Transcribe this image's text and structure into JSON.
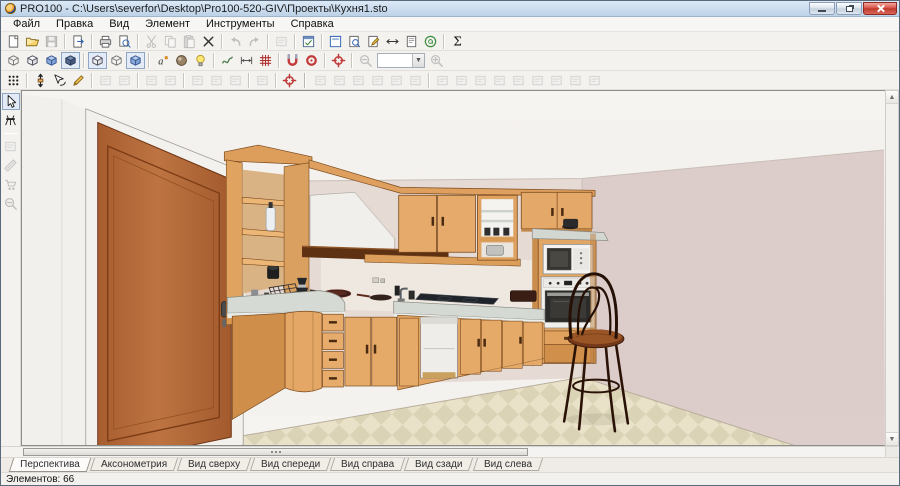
{
  "window": {
    "title": "PRO100 - C:\\Users\\severfor\\Desktop\\Pro100-520-GIV\\Проекты\\Кухня1.sto",
    "controls": [
      {
        "name": "minimize-button"
      },
      {
        "name": "restore-button"
      },
      {
        "name": "close-button"
      }
    ]
  },
  "menu": {
    "items": [
      "Файл",
      "Правка",
      "Вид",
      "Элемент",
      "Инструменты",
      "Справка"
    ]
  },
  "toolbars": {
    "row1": [
      {
        "name": "new-file",
        "i": "doc"
      },
      {
        "name": "open-file",
        "i": "folder"
      },
      {
        "name": "save-file",
        "i": "save",
        "disabled": true
      },
      {
        "sep": true
      },
      {
        "name": "report",
        "i": "docarrow"
      },
      {
        "sep": true
      },
      {
        "name": "print",
        "i": "printer"
      },
      {
        "name": "print-preview",
        "i": "preview"
      },
      {
        "sep": true
      },
      {
        "name": "cut",
        "i": "cut",
        "disabled": true
      },
      {
        "name": "copy",
        "i": "copy",
        "disabled": true
      },
      {
        "name": "paste",
        "i": "paste",
        "disabled": true
      },
      {
        "name": "delete",
        "i": "cross"
      },
      {
        "sep": true
      },
      {
        "name": "undo",
        "i": "undo",
        "disabled": true
      },
      {
        "name": "redo",
        "i": "redo",
        "disabled": true
      },
      {
        "sep": true
      },
      {
        "name": "insert-element",
        "i": "generic",
        "disabled": true
      },
      {
        "sep": true
      },
      {
        "name": "properties-dialog",
        "i": "dialog"
      },
      {
        "sep": true
      },
      {
        "name": "panel-library",
        "i": "pageblue"
      },
      {
        "name": "panel-preview",
        "i": "pagemag"
      },
      {
        "name": "panel-properties",
        "i": "pageedit"
      },
      {
        "name": "panel-dimensions",
        "i": "arrlr"
      },
      {
        "name": "panel-report",
        "i": "pageplain"
      },
      {
        "name": "panel-info",
        "i": "atgreen"
      },
      {
        "sep": true
      },
      {
        "name": "price-list",
        "i": "sigma"
      }
    ],
    "row2": [
      {
        "name": "view-wireframe",
        "i": "boxwire"
      },
      {
        "name": "view-sketch",
        "i": "boxwhite"
      },
      {
        "name": "view-colored",
        "i": "boxblue"
      },
      {
        "name": "view-textured",
        "i": "boxdark",
        "pressed": true
      },
      {
        "sep": true
      },
      {
        "name": "show-contours",
        "i": "boxwhite",
        "pressed": true
      },
      {
        "name": "show-edges",
        "i": "boxwire"
      },
      {
        "name": "show-outline",
        "i": "boxblue",
        "pressed": true
      },
      {
        "sep": true
      },
      {
        "name": "auto-label",
        "i": "alabel"
      },
      {
        "name": "render-quality",
        "i": "sphere"
      },
      {
        "name": "lighting",
        "i": "bulb"
      },
      {
        "sep": true
      },
      {
        "name": "shadows",
        "i": "waves"
      },
      {
        "name": "dimensions-overlay",
        "i": "dimline"
      },
      {
        "name": "grid-overlay",
        "i": "gridred"
      },
      {
        "sep": true
      },
      {
        "name": "snap-to-objects",
        "i": "magnet"
      },
      {
        "name": "snap-to-grid",
        "i": "magnet2"
      },
      {
        "sep": true
      },
      {
        "name": "center-selection",
        "i": "target"
      },
      {
        "sep": true
      },
      {
        "name": "zoom-out",
        "i": "zoomout",
        "disabled": true
      },
      {
        "name": "zoom-level",
        "combo": true,
        "value": ""
      },
      {
        "name": "zoom-in",
        "i": "zoomin",
        "disabled": true
      }
    ],
    "row3": [
      {
        "name": "selection-filter",
        "i": "dotsgrid"
      },
      {
        "sep": true
      },
      {
        "name": "move-element",
        "i": "movearrows"
      },
      {
        "name": "rotate-element",
        "i": "rotatecursor"
      },
      {
        "name": "edit-shape",
        "i": "pencil"
      },
      {
        "sep": true
      },
      {
        "name": "group",
        "i": "generic",
        "disabled": true
      },
      {
        "name": "ungroup",
        "i": "generic",
        "disabled": true
      },
      {
        "sep": true
      },
      {
        "name": "move-up-level",
        "i": "generic",
        "disabled": true
      },
      {
        "name": "move-down-level",
        "i": "generic",
        "disabled": true
      },
      {
        "sep": true
      },
      {
        "name": "rotate-step",
        "i": "generic",
        "disabled": true
      },
      {
        "name": "move-step",
        "i": "generic",
        "disabled": true
      },
      {
        "name": "raise-step",
        "i": "generic",
        "disabled": true
      },
      {
        "sep": true
      },
      {
        "name": "corner-join",
        "i": "generic",
        "disabled": true
      },
      {
        "sep": true
      },
      {
        "name": "center-view",
        "i": "target"
      },
      {
        "sep": "thick"
      },
      {
        "name": "align-tool-1",
        "i": "generic",
        "disabled": true
      },
      {
        "name": "align-tool-2",
        "i": "generic",
        "disabled": true
      },
      {
        "name": "align-tool-3",
        "i": "generic",
        "disabled": true
      },
      {
        "name": "align-tool-4",
        "i": "generic",
        "disabled": true
      },
      {
        "name": "align-tool-5",
        "i": "generic",
        "disabled": true
      },
      {
        "name": "align-tool-6",
        "i": "generic",
        "disabled": true
      },
      {
        "sep": true
      },
      {
        "name": "arrange-tool-1",
        "i": "generic",
        "disabled": true
      },
      {
        "name": "arrange-tool-2",
        "i": "generic",
        "disabled": true
      },
      {
        "name": "arrange-tool-3",
        "i": "generic",
        "disabled": true
      },
      {
        "name": "arrange-tool-4",
        "i": "generic",
        "disabled": true
      },
      {
        "name": "arrange-tool-5",
        "i": "generic",
        "disabled": true
      },
      {
        "name": "arrange-tool-6",
        "i": "generic",
        "disabled": true
      },
      {
        "name": "arrange-tool-7",
        "i": "generic",
        "disabled": true
      },
      {
        "name": "arrange-tool-8",
        "i": "generic",
        "disabled": true
      },
      {
        "name": "arrange-tool-9",
        "i": "generic",
        "disabled": true
      }
    ],
    "left": [
      {
        "name": "pointer-tool",
        "i": "arrow",
        "pressed": true
      },
      {
        "name": "walkthrough-tool",
        "i": "sawhorse"
      },
      {
        "sep": true
      },
      {
        "name": "box-tool",
        "i": "generic",
        "disabled": true
      },
      {
        "name": "ruler-tool",
        "i": "ruler",
        "disabled": true
      },
      {
        "name": "trolley-tool",
        "i": "cart",
        "disabled": true
      },
      {
        "name": "magnifier-tool",
        "i": "zoomout",
        "disabled": true
      }
    ]
  },
  "zoom_combo": {
    "value": ""
  },
  "view_tabs": {
    "items": [
      {
        "label": "Перспектива",
        "active": true
      },
      {
        "label": "Аксонометрия"
      },
      {
        "label": "Вид сверху"
      },
      {
        "label": "Вид спереди"
      },
      {
        "label": "Вид справа"
      },
      {
        "label": "Вид сзади"
      },
      {
        "label": "Вид слева"
      }
    ]
  },
  "status": {
    "text": "Элементов: 66"
  },
  "scene_palette": {
    "ceiling": "#f6f4f1",
    "back_wall": "#e8dcd6",
    "right_wall": "#ddcecb",
    "floor_tile_light": "#eae2c8",
    "floor_tile_dark": "#dbd3b6",
    "cabinet_wood": "#e4a766",
    "door_wood": "#b06a3c",
    "countertop": "#d6dad4",
    "chair_wood": "#74381a"
  }
}
